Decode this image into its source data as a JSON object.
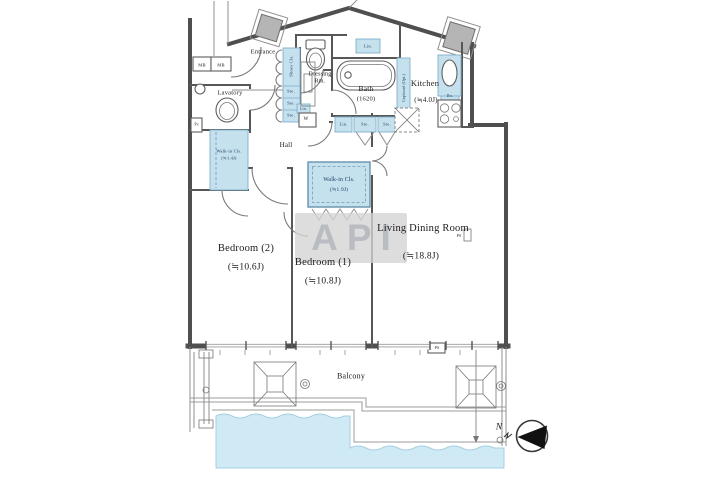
{
  "page": {
    "type": "apartment-floor-plan"
  },
  "rooms": {
    "entrance": {
      "label": "Entrance"
    },
    "shoes_closet": {
      "label": "Shoes Cls."
    },
    "lavatory": {
      "label": "Lavatory"
    },
    "dressing_room": {
      "label": "Dressing Rm."
    },
    "bath": {
      "label": "Bath",
      "size": "(1620)"
    },
    "kitchen": {
      "label": "Kitchen",
      "size": "(≒4.0J)"
    },
    "hall": {
      "label": "Hall"
    },
    "walkin_closet_1": {
      "label": "Walk-in Cls.",
      "size": "(≒1.4J)"
    },
    "walkin_closet_2": {
      "label": "Walk-in Cls.",
      "size": "(≒1.9J)"
    },
    "bedroom_2": {
      "label": "Bedroom (2)",
      "size": "(≒10.6J)"
    },
    "bedroom_1": {
      "label": "Bedroom (1)",
      "size": "(≒10.8J)"
    },
    "living_dining": {
      "label": "Living Dining Room",
      "size": "(≒18.8J)"
    },
    "balcony": {
      "label": "Balcony"
    }
  },
  "fixtures": {
    "meter_box": "MB",
    "pipe_space_abbr": "Ps",
    "pipe_space": "PS",
    "washing_machine": "W",
    "linen": "Lin.",
    "storage": "Sto.",
    "cupboard": "Cupboard (Opt.)",
    "disposer": "Dis."
  },
  "compass": {
    "north": "N"
  },
  "watermark": {
    "text": "API"
  },
  "colors": {
    "wall_color": "#4f4f4f",
    "closet_fill": "#c5e1ee",
    "closet_text": "#17395c",
    "water_fill": "#cfe9f5",
    "pillar_fill": "#b5b5b5",
    "watermark_bg": "#d4d4d4",
    "watermark_text": "#a6abb2"
  }
}
